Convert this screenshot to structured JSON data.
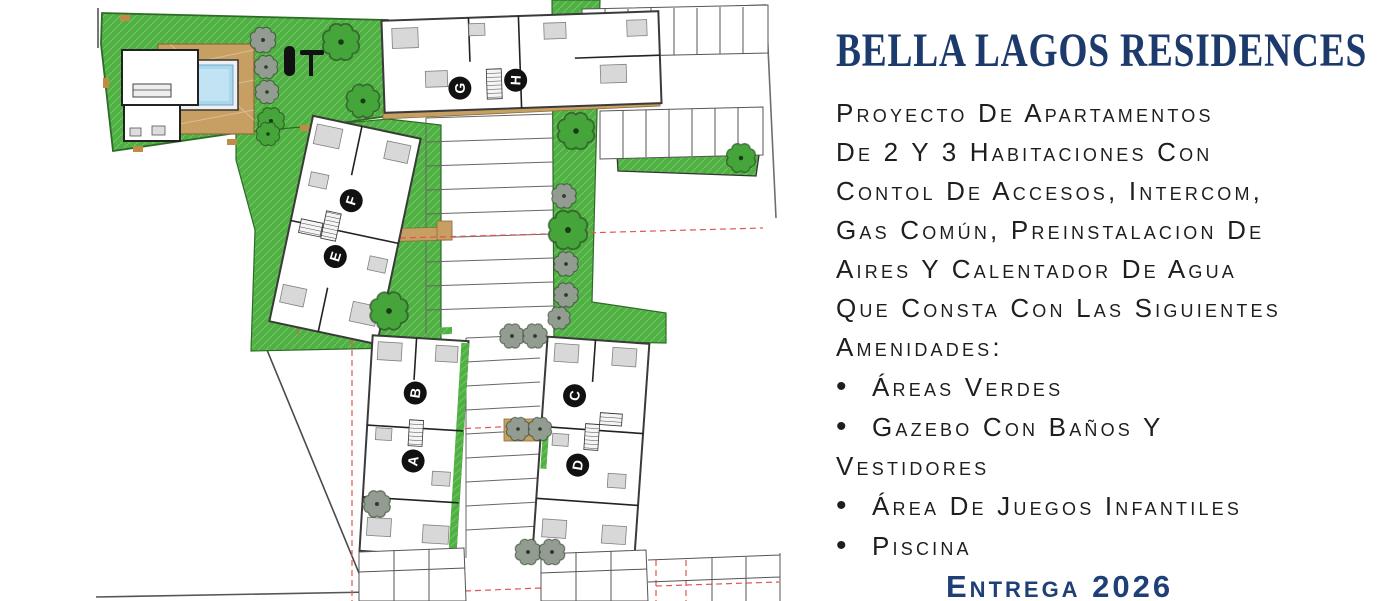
{
  "title": "BELLA LAGOS RESIDENCES",
  "description": {
    "lines": [
      "Proyecto De Apartamentos",
      "De 2 Y 3 Habitaciones Con",
      "Contol De Accesos, Intercom,",
      "Gas Común, Preinstalacion De",
      "Aires Y Calentador De Agua",
      "Que Consta Con Las Siguientes",
      "Amenidades:"
    ]
  },
  "amenities": [
    {
      "lines": [
        "Áreas Verdes"
      ]
    },
    {
      "lines": [
        "Gazebo Con Baños Y",
        "Vestidores"
      ]
    },
    {
      "lines": [
        "Área De Juegos Infantiles"
      ]
    },
    {
      "lines": [
        "Piscina"
      ]
    }
  ],
  "delivery": "Entrega 2026",
  "ui": {
    "bullet": "•"
  },
  "site_plan": {
    "buildings": [
      {
        "label": "A"
      },
      {
        "label": "B"
      },
      {
        "label": "C"
      },
      {
        "label": "D"
      },
      {
        "label": "E"
      },
      {
        "label": "F"
      },
      {
        "label": "G"
      },
      {
        "label": "H"
      }
    ],
    "features": [
      "pool",
      "pool-deck",
      "gazebo-with-baths",
      "playground",
      "green-areas",
      "parking-stalls",
      "trees"
    ],
    "colors": {
      "grass_green": "#4fb141",
      "deck_tan": "#c89f63",
      "pool_blue": "#a9d7ee",
      "boundary_red": "#e05555",
      "title_navy": "#1d3a6d",
      "delivery_navy": "#1e4077",
      "body_text": "#1e1e1e"
    }
  }
}
